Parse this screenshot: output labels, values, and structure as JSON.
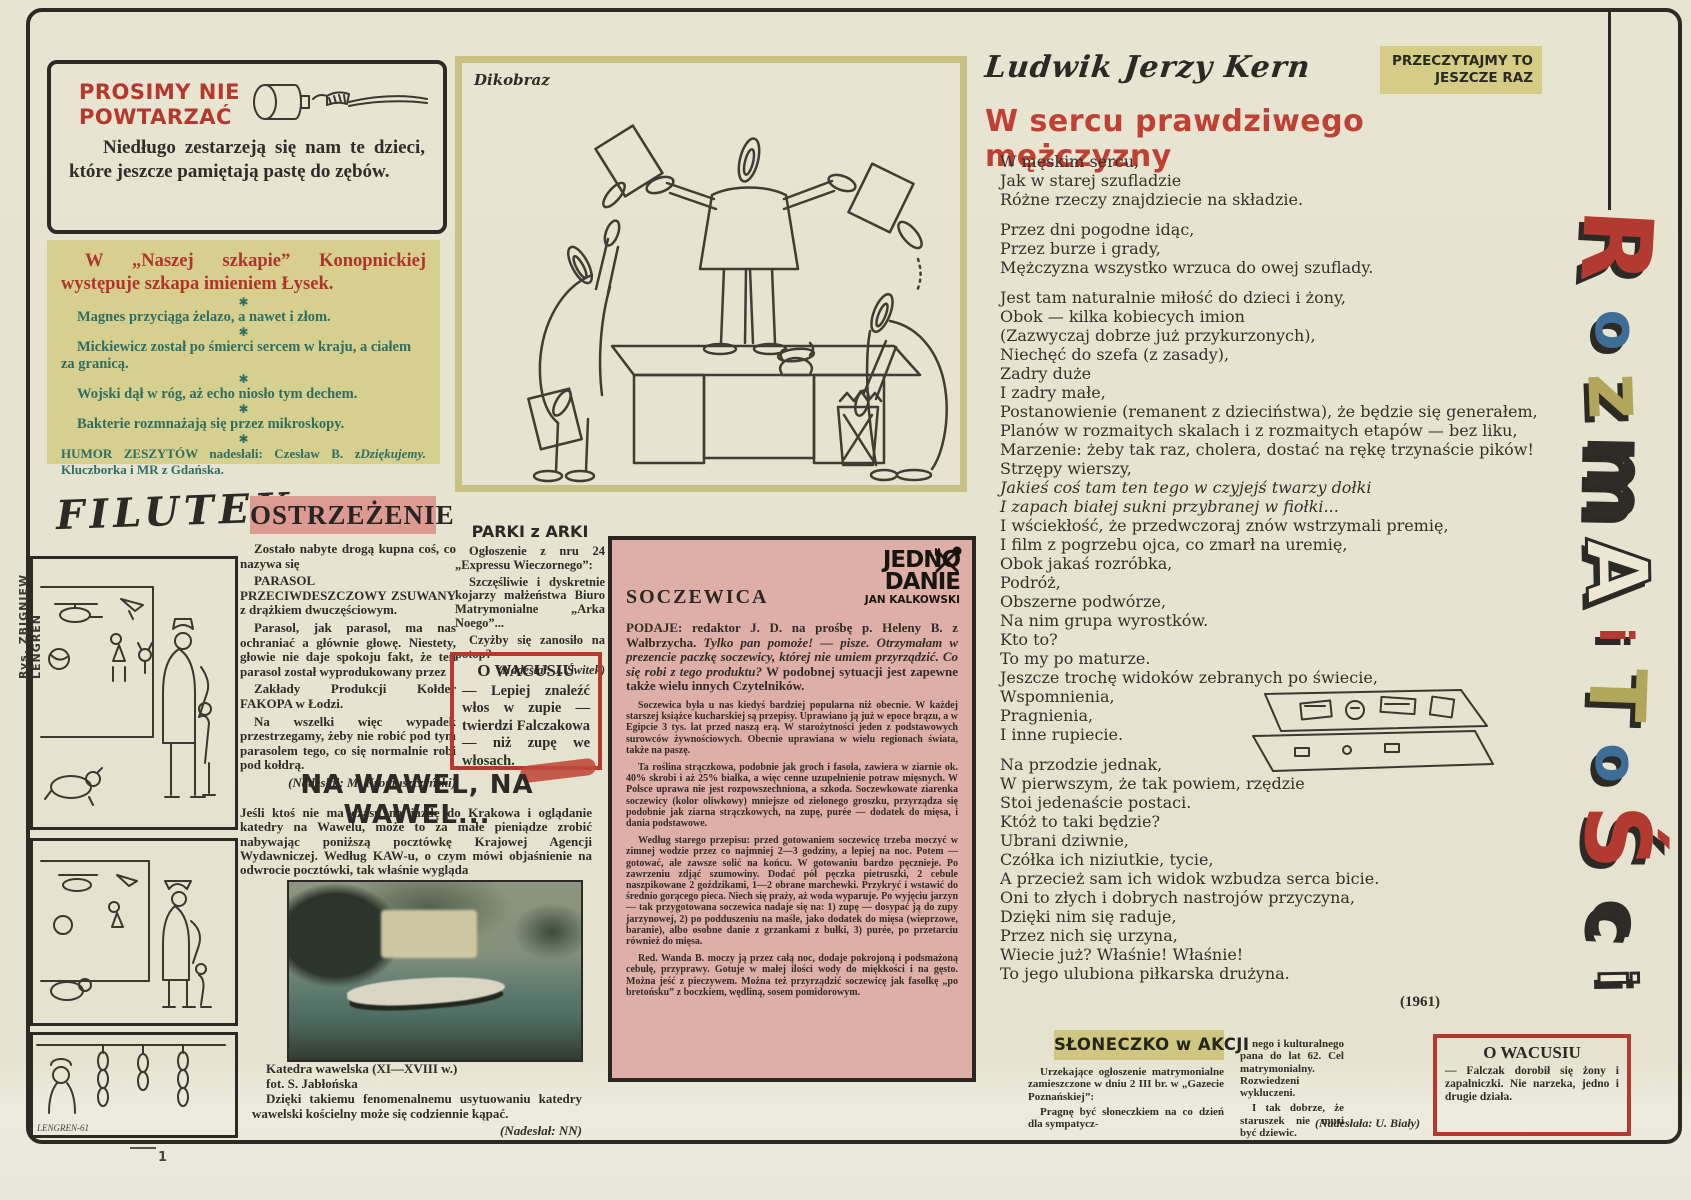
{
  "page": {
    "side_credit": "Rys. ZBIGNIEW LENGREN",
    "page_mark": "1"
  },
  "prosimy": {
    "title_line1": "PROSIMY NIE",
    "title_line2": "POWTARZAĆ",
    "body": "Niedługo zestarzeją się nam te dzieci, które jeszcze pamiętają pastę do zębów."
  },
  "humor": {
    "header": "W „Naszej szkapie” Konopnickiej występuje szkapa imieniem Łysek.",
    "star": "✱",
    "items": [
      "Magnes przyciąga żelazo, a nawet i złom.",
      "Mickiewicz został po śmierci sercem w kraju, a ciałem za granicą.",
      "Wojski dął w róg, aż echo niosło tym dechem.",
      "Bakterie rozmnażają się przez mikroskopy."
    ],
    "footer": "HUMOR ZESZYTÓW nadesłali: Czesław B. z Kluczborka i MR z Gdańska.",
    "footer_thanks": "Dziękujemy."
  },
  "filutek": {
    "title": "FILUTEK",
    "signature": "LENGREN-61"
  },
  "ostrzezenie": {
    "heading": "OSTRZEŻENIE",
    "p1": "Zostało nabyte drogą kupna coś, co nazywa się",
    "p2": "PARASOL PRZECIWDESZCZOWY ZSUWANY z drążkiem dwuczęściowym.",
    "p3": "Parasol, jak parasol, ma nas ochraniać a głównie głowę. Niestety, głowie nie daje spokoju fakt, że ten parasol został wyprodukowany przez",
    "p4": "Zakłady Produkcji Kołder FAKOPA w Łodzi.",
    "p5": "Na wszelki więc wypadek przestrzegamy, żeby nie robić pod tym parasolem tego, co się normalnie robi pod kołdrą.",
    "credit": "(Nadesłał: M. Kromuszczyński)"
  },
  "parki": {
    "heading": "PARKI z ARKI",
    "p1": "Ogłoszenie z nru 24 „Expressu Wieczornego”:",
    "p2": "Szczęśliwie i dyskretnie kojarzy małżeństwa Biuro Matrymonialne „Arka Noego”...",
    "p3": "Czyżby się zanosiło na potop?",
    "credit": "(Nadesłał: J. Świtek)"
  },
  "wacusiu1": {
    "heading": "O WACUSIU",
    "body": "— Lepiej znaleźć włos w zupie — twierdzi Falczakowa — niż zupę we włosach."
  },
  "wawel": {
    "heading": "NA WAWEL, NA WAWEL...",
    "intro": "Jeśli ktoś nie ma czasu na jazdę do Krakowa i oglądanie katedry na Wawelu, może to za małe pieniądze zrobić nabywając poniższą pocztówkę Krajowej Agencji Wydawniczej. Według KAW-u, o czym mówi objaśnienie na odwrocie pocztówki, tak właśnie wygląda",
    "caption1": "Katedra wawelska (XI—XVIII w.)",
    "caption2": "fot. S. Jabłońska",
    "caption3": "Dzięki takiemu fenomenalnemu usytuowaniu katedry wawelski kościelny może się codziennie kąpać.",
    "credit": "(Nadesłał: NN)"
  },
  "dikobraz": {
    "label": "Dikobraz"
  },
  "soczewica": {
    "logo_line1": "JEDNO",
    "logo_line2": "DANIE",
    "logo_line3": "JAN KALKOWSKI",
    "title": "SOCZEWICA",
    "lead_label": "PODAJE:",
    "lead_roman": "redaktor J. D. na prośbę p. Heleny B. z Wałbrzycha.",
    "lead_italic": "Tylko pan pomoże! — pisze. Otrzymałam w prezencie paczkę soczewicy, której nie umiem przyrządzić. Co się robi z tego produktu?",
    "lead_tail": "W podobnej sytuacji jest zapewne także wielu innych Czytelników.",
    "p1": "Soczewica była u nas kiedyś bardziej popularna niż obecnie. W każdej starszej książce kucharskiej są przepisy. Uprawiano ją już w epoce brązu, a w Egipcie 3 tys. lat przed naszą erą. W starożytności jeden z podstawowych surowców żywnościowych. Obecnie uprawiana w wielu regionach świata, także na paszę.",
    "p2": "Ta roślina strączkowa, podobnie jak groch i fasola, zawiera w ziarnie ok. 40% skrobi i aż 25% białka, a więc cenne uzupełnienie potraw mięsnych. W Polsce uprawa nie jest rozpowszechniona, a szkoda. Soczewkowate ziarenka soczewicy (kolor oliwkowy) mniejsze od zielonego groszku, przyrządza się podobnie jak ziarna strączkowych, na zupę, purée — dodatek do mięsa, i dania podstawowe.",
    "p3": "Według starego przepisu: przed gotowaniem soczewicę trzeba moczyć w zimnej wodzie przez co najmniej 2—3 godziny, a lepiej na noc. Potem — gotować, ale zawsze solić na końcu. W gotowaniu bardzo pęcznieje. Po zawrzeniu zdjąć szumowiny. Dodać pół pęczka pietruszki, 2 cebule naszpikowane 2 goździkami, 1—2 obrane marchewki. Przykryć i wstawić do średnio gorącego pieca. Niech się praży, aż woda wyparuje. Po wyjęciu jarzyn — tak przygotowana soczewica nadaje się na: 1) zupę — dosypać ją do zupy jarzynowej, 2) po podduszeniu na maśle, jako dodatek do mięsa (wieprzowe, baranie), albo osobne danie z grzankami z bułki, 3) purée, po przetarciu również do mięsa.",
    "p4": "Red. Wanda B. moczy ją przez całą noc, dodaje pokrojoną i podsmażoną cebulę, przyprawy. Gotuje w małej ilości wody do miękkości i na gęsto. Można jeść z pieczywem. Można też przyrządzić soczewicę jak fasolkę „po bretońsku” z boczkiem, wędliną, sosem pomidorowym."
  },
  "kern": {
    "author": "Ludwik Jerzy Kern",
    "badge_line1": "PRZECZYTAJMY TO",
    "badge_line2": "JESZCZE RAZ",
    "title": "W sercu prawdziwego mężczyzny",
    "title_color": "#bf4136",
    "year": "(1961)",
    "stanzas": {
      "s1": [
        "W męskim sercu,",
        "Jak w starej szufladzie",
        "Różne rzeczy znajdziecie na składzie."
      ],
      "s2": [
        "Przez dni pogodne idąc,",
        "Przez burze i grady,",
        "Mężczyzna wszystko wrzuca do owej szuflady."
      ],
      "s3a": [
        "Jest tam naturalnie miłość do dzieci i żony,",
        "Obok — kilka kobiecych imion",
        "(Zazwyczaj dobrze już przykurzonych),",
        "Niechęć do szefa (z zasady),",
        "Zadry duże",
        "I zadry małe,",
        "Postanowienie (remanent z dzieciństwa), że będzie się generałem,",
        "Planów w rozmaitych skalach i z rozmaitych etapów — bez liku,",
        "Marzenie: żeby tak raz, cholera, dostać na rękę trzynaście pików!",
        "Strzępy wierszy,"
      ],
      "s3i": [
        "Jakieś coś tam ten tego w czyjejś twarzy dołki",
        "I zapach białej sukni przybranej w fiołki..."
      ],
      "s3b": [
        "I wściekłość, że przedwczoraj znów wstrzymali premię,",
        "I film z pogrzebu ojca, co zmarł na uremię,",
        "Obok jakaś rozróbka,",
        "Podróż,",
        "Obszerne podwórze,",
        "Na nim grupa wyrostków.",
        "Kto to?",
        "To my po maturze.",
        "Jeszcze trochę widoków zebranych po świecie,",
        "Wspomnienia,",
        "Pragnienia,",
        "I inne rupiecie."
      ],
      "s4": [
        "Na przodzie jednak,",
        "W pierwszym, że tak powiem, rzędzie",
        "Stoi jedenaście postaci.",
        "Któż to taki będzie?",
        "Ubrani dziwnie,",
        "Czółka ich niziutkie, tycie,",
        "A przecież sam ich widok wzbudza serca bicie.",
        "Oni to złych i dobrych nastrojów przyczyna,",
        "Dzięki nim się raduje,",
        "Przez nich się urzyna,",
        "Wiecie już? Właśnie! Właśnie!",
        "To jego ulubiona piłkarska drużyna."
      ]
    }
  },
  "sloneczko": {
    "heading": "SŁONECZKO w AKCJI",
    "col1_p1": "Urzekające ogłoszenie matrymonialne zamieszczone w dniu 2 III br. w „Gazecie Poznańskiej”:",
    "col1_p2": "Pragnę być słoneczkiem na co dzień dla sympatycz-",
    "col2_p1": "nego i kulturalnego pana do lat 62. Cel matrymonialny. Rozwiedzeni wykluczeni.",
    "col2_p2": "I tak dobrze, że staruszek nie musi być dziewic.",
    "credit": "(Nadesłała: U. Biały)"
  },
  "wacusiu2": {
    "heading": "O WACUSIU",
    "body": "— Falczak dorobił się żony i zapalniczki. Nie narzeka, jedno i drugie działa."
  },
  "rozmaitosci": {
    "letters": [
      {
        "ch": "R",
        "color": "#b23a31"
      },
      {
        "ch": "o",
        "color": "#3e6d98"
      },
      {
        "ch": "z",
        "color": "#b2a65a"
      },
      {
        "ch": "m",
        "color": "#2e2c26"
      },
      {
        "ch": "A",
        "color": "#ece8d3"
      },
      {
        "ch": "i",
        "color": "#b23a31"
      },
      {
        "ch": "T",
        "color": "#b2a65a"
      },
      {
        "ch": "o",
        "color": "#3e6d98"
      },
      {
        "ch": "Ś",
        "color": "#b23a31"
      },
      {
        "ch": "c",
        "color": "#2e2c26"
      },
      {
        "ch": "i",
        "color": "#ece8d3"
      }
    ]
  }
}
